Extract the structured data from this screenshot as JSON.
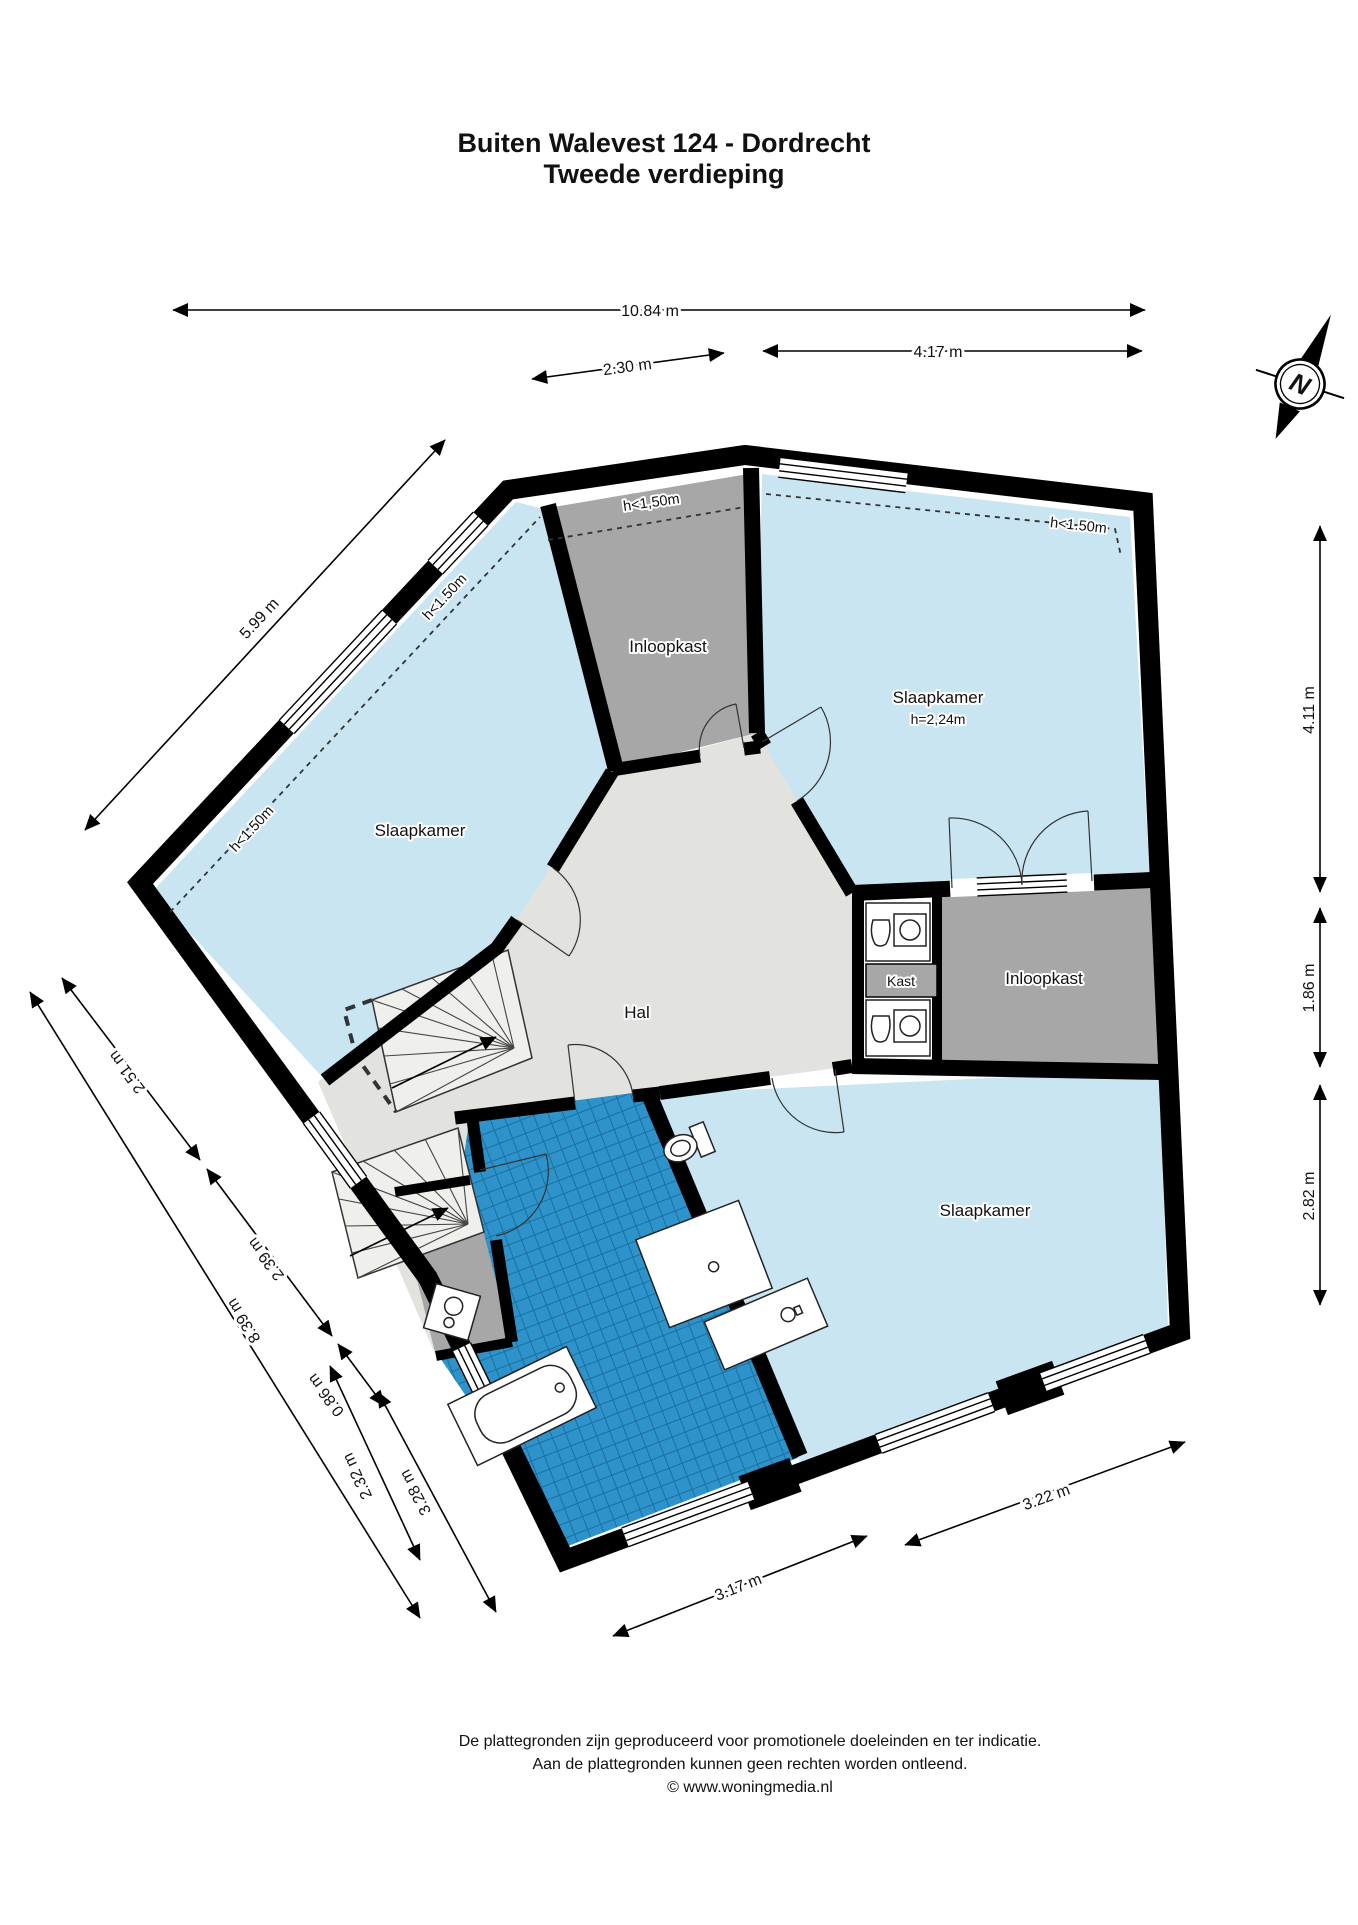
{
  "title": {
    "line1": "Buiten Walevest 124 - Dordrecht",
    "line2": "Tweede verdieping"
  },
  "compass": {
    "north_label": "N"
  },
  "rooms": {
    "slaapkamer_left": {
      "label": "Slaapkamer"
    },
    "slaapkamer_top_right": {
      "label": "Slaapkamer",
      "height": "h=2,24m"
    },
    "slaapkamer_bottom_right": {
      "label": "Slaapkamer"
    },
    "inloopkast_top": {
      "label": "Inloopkast"
    },
    "inloopkast_right": {
      "label": "Inloopkast"
    },
    "kast": {
      "label": "Kast"
    },
    "hal": {
      "label": "Hal"
    }
  },
  "height_notes": {
    "upper_left_wall": "h<1.50m",
    "left_wall": "h<1.50m",
    "inloopkast": "h<1,50m",
    "top_right": "h<1.50m"
  },
  "dimensions": {
    "top_total": "10.84 m",
    "top_left": "2.30 m",
    "top_right": "4.17 m",
    "upper_left_wall": "5.99 m",
    "right_top": "4.11 m",
    "right_middle": "1.86 m",
    "right_bottom": "2.82 m",
    "left_seg_1": "2.51 m",
    "left_seg_2": "2.39 m",
    "left_seg_3": "0.86 m",
    "left_seg_4": "3.28 m",
    "left_seg_5": "2.32 m",
    "left_total": "8.39 m",
    "bottom_left": "3.17 m",
    "bottom_right": "3.22 m"
  },
  "footer": {
    "line1": "De plattegronden zijn geproduceerd voor promotionele doeleinden en ter indicatie.",
    "line2": "Aan de plattegronden kunnen geen rechten worden ontleend.",
    "line3": "© www.woningmedia.nl"
  },
  "colors": {
    "room_blue": "#c9e5f2",
    "closet_gray": "#a7a7a7",
    "hall_gray": "#e2e2de",
    "tile_blue": "#2d93ca",
    "tile_line": "#1b6fa0",
    "wall_black": "#000000"
  }
}
